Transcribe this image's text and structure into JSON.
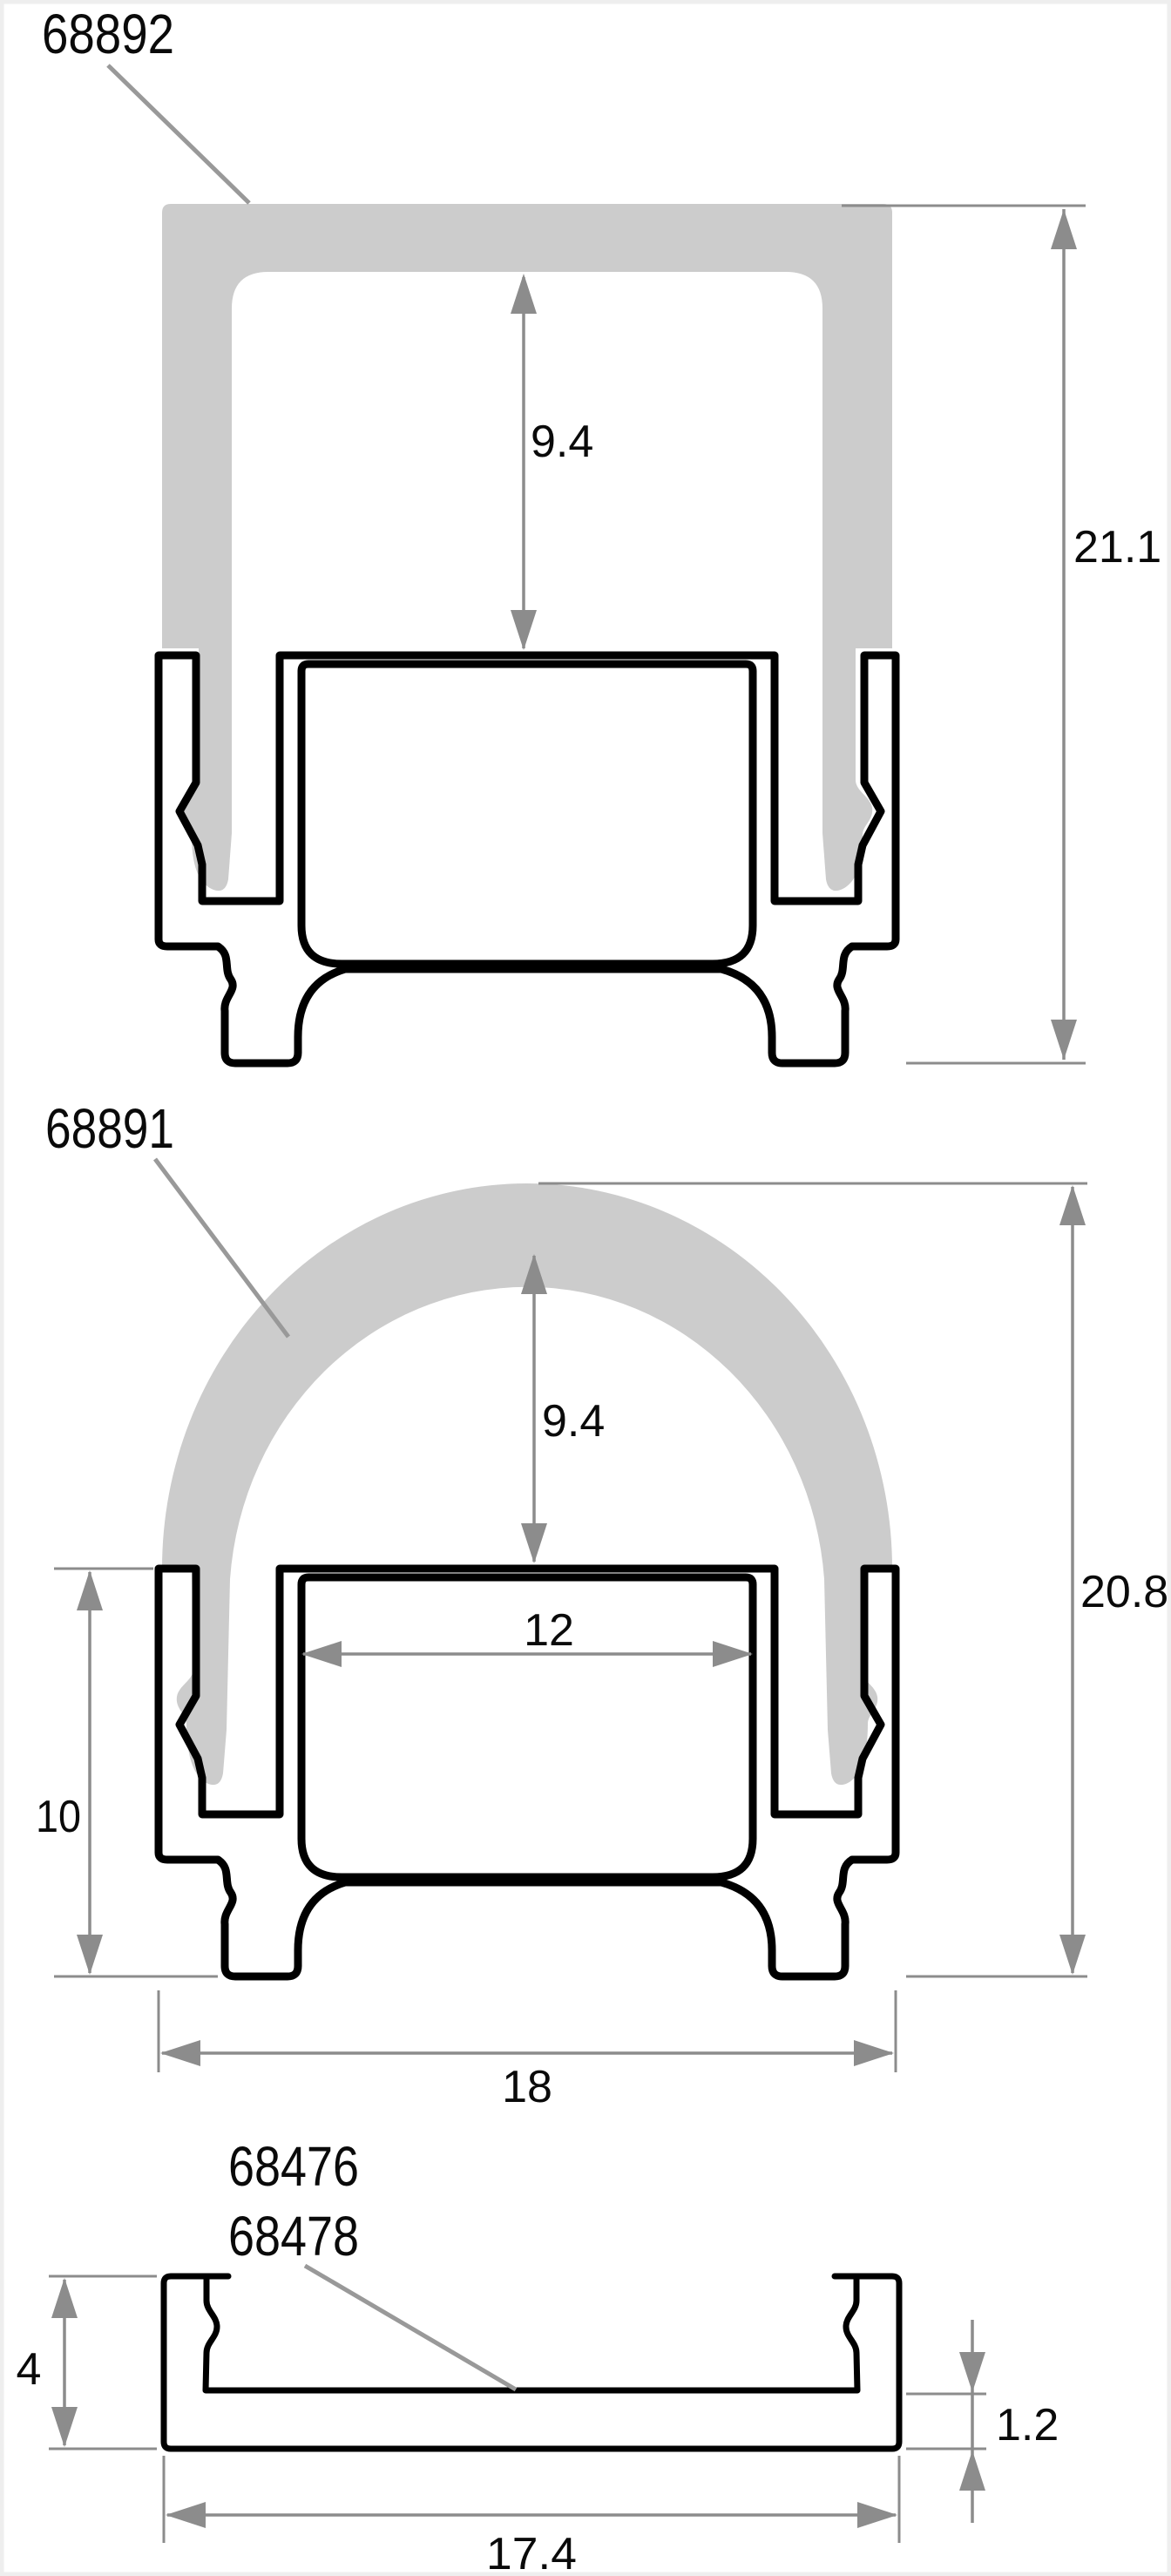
{
  "document": {
    "type": "technical-cross-section-sheet",
    "subject": "LED aluminium profile cross sections with clip-on covers"
  },
  "colors": {
    "cover_fill": "#cccccc",
    "outline": "#000000",
    "dimension": "#8c8c8c",
    "leader": "#999999",
    "text": "#0a0a0a",
    "page_edge": "#eeeeee",
    "background": "#ffffff"
  },
  "drawings": [
    {
      "name": "square high cover on base profile",
      "part_label": "68892",
      "dimensions": {
        "inner_height": "9.4",
        "total_height": "21.1"
      }
    },
    {
      "name": "round dome cover on base profile",
      "part_label": "68891",
      "dimensions": {
        "inner_height": "9.4",
        "channel_width": "12",
        "base_height": "10",
        "total_height": "20.8",
        "total_width": "18"
      }
    },
    {
      "name": "flat mounting profile",
      "part_labels": [
        "68476",
        "68478"
      ],
      "dimensions": {
        "height": "4",
        "floor_thickness": "1.2",
        "total_width": "17.4"
      }
    }
  ]
}
